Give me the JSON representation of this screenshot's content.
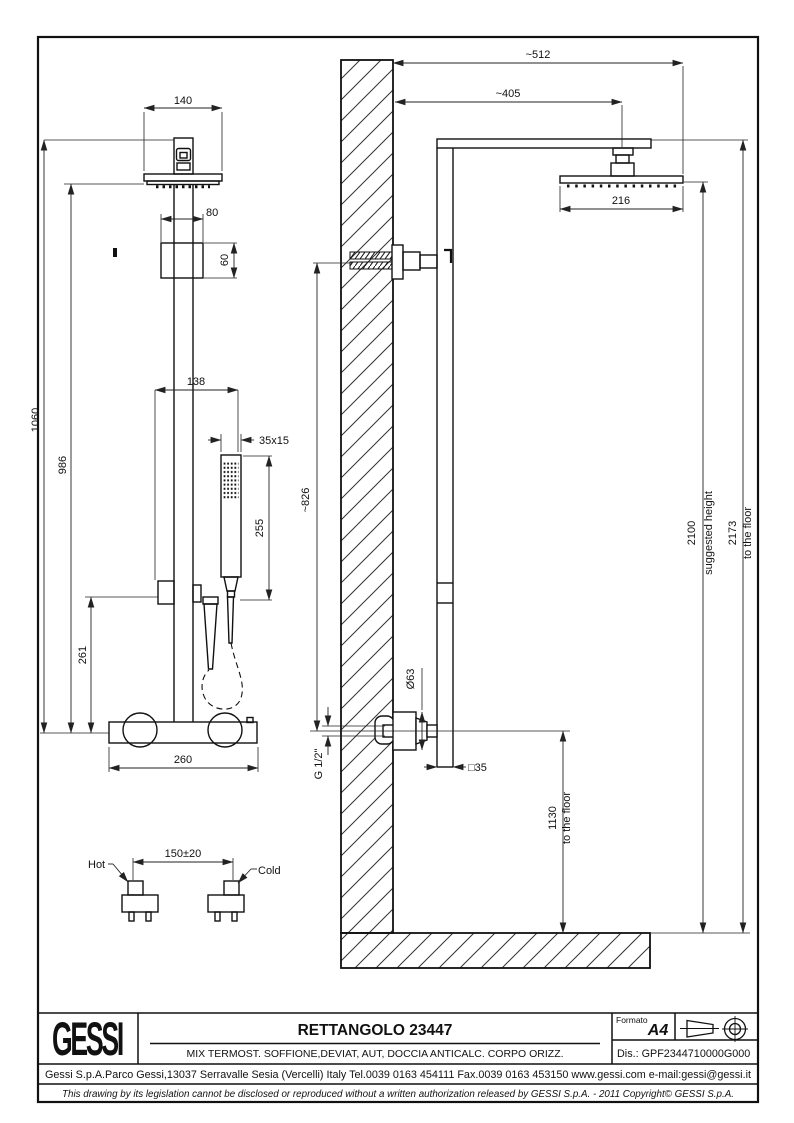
{
  "drawing": {
    "front_view": {
      "dims": {
        "head_width": "140",
        "bracket_width": "80",
        "bracket_height": "60",
        "handshower_offset": "138",
        "handshower_section": "35x15",
        "handshower_length": "255",
        "overall_height": "1060",
        "head_to_mixer": "986",
        "holder_to_mixer": "261",
        "mixer_width": "260",
        "supply_spacing": "150±20"
      },
      "labels": {
        "hot": "Hot",
        "cold": "Cold"
      }
    },
    "side_view": {
      "dims": {
        "arm_reach": "~512",
        "head_center_offset": "~405",
        "head_depth": "216",
        "wall_outlet_to_mixer": "~826",
        "suggested_height_value": "2100",
        "suggested_height_label": "suggested height",
        "total_height_value": "2173",
        "total_height_label": "to the floor",
        "flange_diameter": "Ø63",
        "thread": "G 1/2\"",
        "column_section": "□35",
        "mixer_height_value": "1130",
        "mixer_height_label": "to the floor"
      }
    }
  },
  "title_block": {
    "brand": "GESSI",
    "title": "RETTANGOLO 23447",
    "subtitle": "MIX TERMOST. SOFFIONE,DEVIAT, AUT, DOCCIA ANTICALC. CORPO ORIZZ.",
    "formato_label": "Formato",
    "formato_value": "A4",
    "drawing_number": "Dis.: GPF2344710000G000",
    "address": "Gessi S.p.A.Parco Gessi,13037 Serravalle Sesia (Vercelli) Italy Tel.0039 0163 454111 Fax.0039 0163 453150 www.gessi.com e-mail:gessi@gessi.it",
    "disclaimer": "This drawing by its legislation cannot be disclosed or reproduced without a written authorization released by GESSI S.p.A. - 2011 Copyright© GESSI S.p.A."
  }
}
